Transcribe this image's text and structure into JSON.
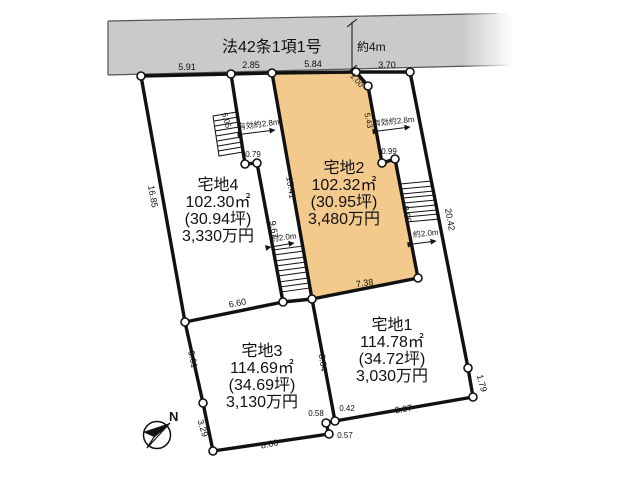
{
  "road": {
    "law_label": "法42条1項1号",
    "width_label": "約4m"
  },
  "lots": {
    "lot1": {
      "name": "宅地1",
      "area": "114.78㎡",
      "tsubo": "(34.72坪)",
      "price": "3,030万円"
    },
    "lot2": {
      "name": "宅地2",
      "area": "102.32㎡",
      "tsubo": "(30.95坪)",
      "price": "3,480万円"
    },
    "lot3": {
      "name": "宅地3",
      "area": "114.69㎡",
      "tsubo": "(34.69坪)",
      "price": "3,130万円"
    },
    "lot4": {
      "name": "宅地4",
      "area": "102.30㎡",
      "tsubo": "(30.94坪)",
      "price": "3,330万円"
    }
  },
  "dims": {
    "frontage_lot4": "5.91",
    "frontage_lot3_pole": "2.85",
    "frontage_lot2": "5.84",
    "frontage_lot1_pole": "3.70",
    "jog_100": "1.00",
    "left_boundary": "16.85",
    "stair_edge_left": "6.05",
    "eff_width_left": "有効約2.8m",
    "jog_079": "0.79",
    "lot2_left": "15.41",
    "lot4_right": "9.67",
    "pole_width_left": "約2.0m",
    "lot4_bottom": "6.60",
    "lot2_right_upper": "5.43",
    "eff_width_right": "有効約2.8m",
    "jog_099": "0.99",
    "lot2_right_lower": "8.09",
    "right_boundary": "20.42",
    "pole_width_right": "約2.0m",
    "lot2_bottom": "7.38",
    "lot13_border": "8.64",
    "lot3_left_upper": "5.61",
    "lot3_left_lower": "3.29",
    "lot3_bottom": "8.06",
    "jog_058": "0.58",
    "jog_042": "0.42",
    "jog_057": "0.57",
    "lot1_bottom": "8.97",
    "right_boundary_lower": "1.79"
  },
  "compass": {
    "north": "N"
  },
  "colors": {
    "lot2_fill": "#F3CA8C",
    "road_fill": "#CACACA",
    "line": "#111111"
  }
}
